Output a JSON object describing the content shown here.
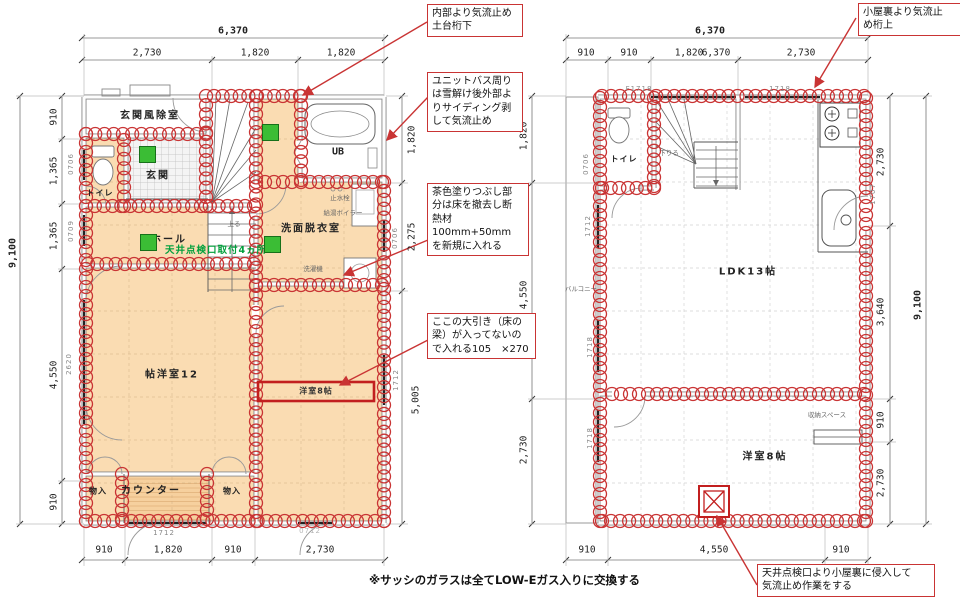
{
  "note": "※サッシのガラスは全てLOW-Eガス入りに交換する",
  "callouts": {
    "c1": "内部より気流止め\n土台桁下",
    "c2": "ユニットバス周り\nは雪解け後外部よ\nりサイディング剥\nして気流止め",
    "c3": "茶色塗りつぶし部\n分は床を撤去し断\n熱材100mm+50mm\nを新規に入れる",
    "c4": "ここの大引き（床の\n梁）が入ってないの\nで入れる105　×270",
    "c5": "小屋裏より気流止\nめ桁上",
    "c6": "天井点検口より小屋裏に侵入して\n気流止め作業をする"
  },
  "floor1": {
    "rooms": {
      "windbreak": "玄関風除室",
      "genkan": "玄関",
      "toilet": "トイレ",
      "hall": "ホール",
      "washroom": "洗面脱衣室",
      "bath": "UB",
      "room12": "帖洋室12",
      "room8": "洋室8帖",
      "counter": "カウンター",
      "closet1": "物入",
      "closet2": "物入"
    },
    "green_note": "天井点検口取付4ヵ所",
    "tiny": {
      "up": "上る",
      "stop_valve": "止水栓",
      "boiler": "給湯ボイラー",
      "washer": "洗濯機"
    },
    "dims": {
      "top_total": "6,370",
      "top": [
        "2,730",
        "1,820",
        "1,820"
      ],
      "left_total": "9,100",
      "left": [
        "910",
        "1,365",
        "1,365",
        "4,550",
        "910"
      ],
      "right": [
        "1,820",
        "2,275",
        "5,005"
      ],
      "bottom": [
        "910",
        "1,820",
        "910",
        "2,730"
      ]
    },
    "codes": {
      "w1": "0706",
      "w2": "0709",
      "w3": "2620",
      "e1": "0706",
      "e2": "1712",
      "s1": "1712",
      "s2": "0712"
    }
  },
  "floor2": {
    "rooms": {
      "toilet": "トイレ",
      "ldk": "LDK13帖",
      "room8": "洋室8帖",
      "balcony": "バルコニー",
      "storage": "収納スペース"
    },
    "tiny": {
      "down": "下りる"
    },
    "dims": {
      "top_total": "6,370",
      "top": [
        "910",
        "910",
        "1,820",
        "2,730"
      ],
      "top_overlap": "6,370",
      "left": [
        "1,820",
        "4,550",
        "2,730"
      ],
      "right": [
        "2,730",
        "3,640",
        "910",
        "2,730"
      ],
      "right_total": "9,100",
      "bottom": [
        "910",
        "4,550",
        "910"
      ]
    },
    "codes": {
      "n1": "F1718",
      "n2": "1718",
      "w1": "0706",
      "w2": "1712",
      "w3": "1718",
      "w4": "1718",
      "e1": "1707"
    }
  },
  "colors": {
    "markup_red": "#c93434",
    "floor_orange": "#fadcb2",
    "green_square": "#3bbd35",
    "green_text": "#00a03c"
  }
}
